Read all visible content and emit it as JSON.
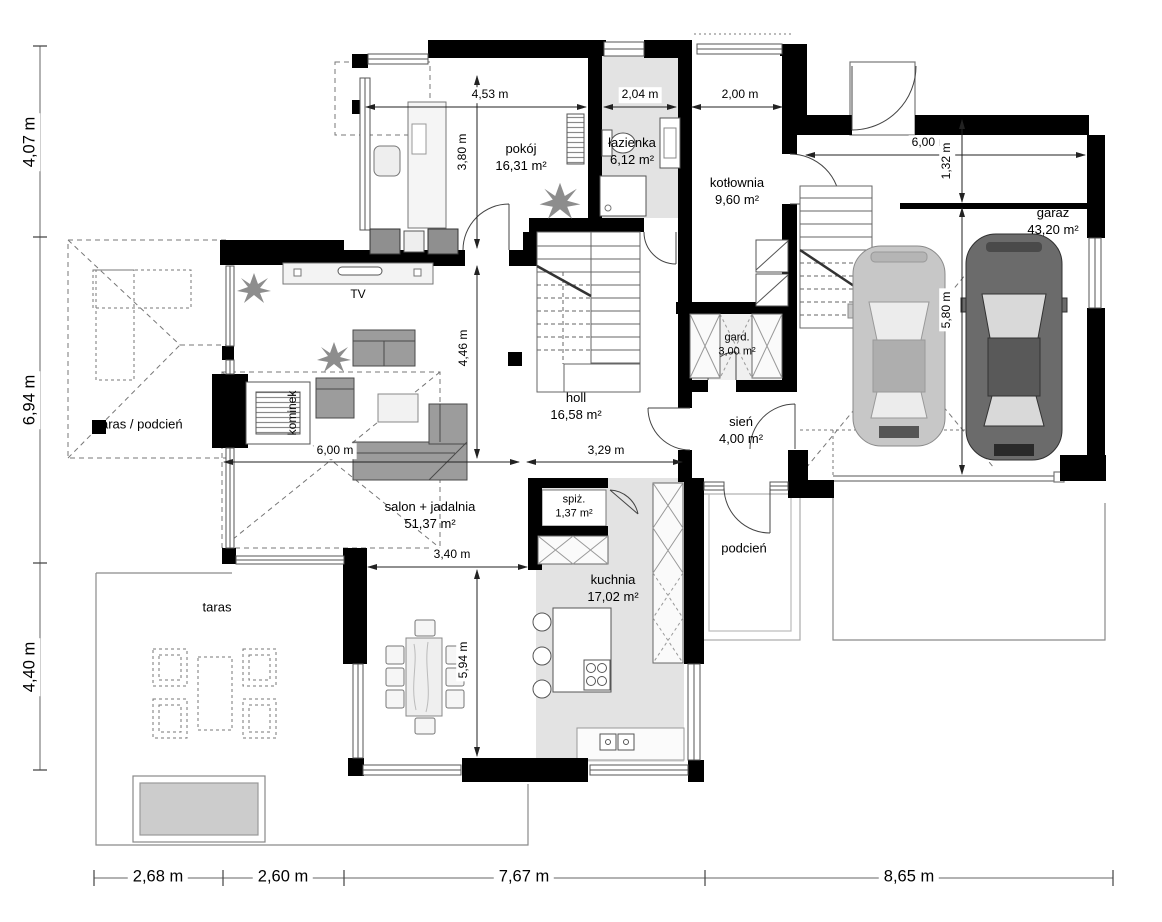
{
  "rooms": {
    "pokoj": {
      "name": "pokój",
      "area": "16,31 m²"
    },
    "lazienka": {
      "name": "łazienka",
      "area": "6,12 m²"
    },
    "kotlownia": {
      "name": "kotłownia",
      "area": "9,60 m²"
    },
    "garaz": {
      "name": "garaż",
      "area": "43,20 m²"
    },
    "gard": {
      "name": "gard.",
      "area": "3,00 m²"
    },
    "holl": {
      "name": "holl",
      "area": "16,58 m²"
    },
    "sien": {
      "name": "sień",
      "area": "4,00 m²"
    },
    "salon": {
      "name": "salon + jadalnia",
      "area": "51,37 m²"
    },
    "spiz": {
      "name": "spiż.",
      "area": "1,37 m²"
    },
    "kuchnia": {
      "name": "kuchnia",
      "area": "17,02 m²"
    }
  },
  "zones": {
    "taras_podcien": "taras / podcień",
    "taras": "taras",
    "podcien": "podcień",
    "kominek": "kominek",
    "tv": "TV"
  },
  "dims": {
    "pokoj_w": "4,53 m",
    "lazienka_w": "2,04 m",
    "kotlownia_w": "2,00 m",
    "garaz_w": "6,00 m",
    "garaz_strip": "1,32 m",
    "garaz_d": "5,80 m",
    "pokoj_d": "3,80 m",
    "holl_d": "4,46 m",
    "jadalnia_d": "5,94 m",
    "salon_w": "6,00 m",
    "holl_w": "3,29 m",
    "jadalnia_w": "3,40 m",
    "left": [
      "4,07 m",
      "6,94 m",
      "4,40 m"
    ],
    "bottom": [
      "2,68 m",
      "2,60 m",
      "7,67 m",
      "8,65 m"
    ]
  },
  "colors": {
    "wall": "#000000",
    "floor_accent": "#e3e3e3",
    "furniture": "#9c9c9c",
    "car_light": "#c7c7c7",
    "car_dark": "#6b6b6b",
    "dimension_line": "#222222"
  }
}
